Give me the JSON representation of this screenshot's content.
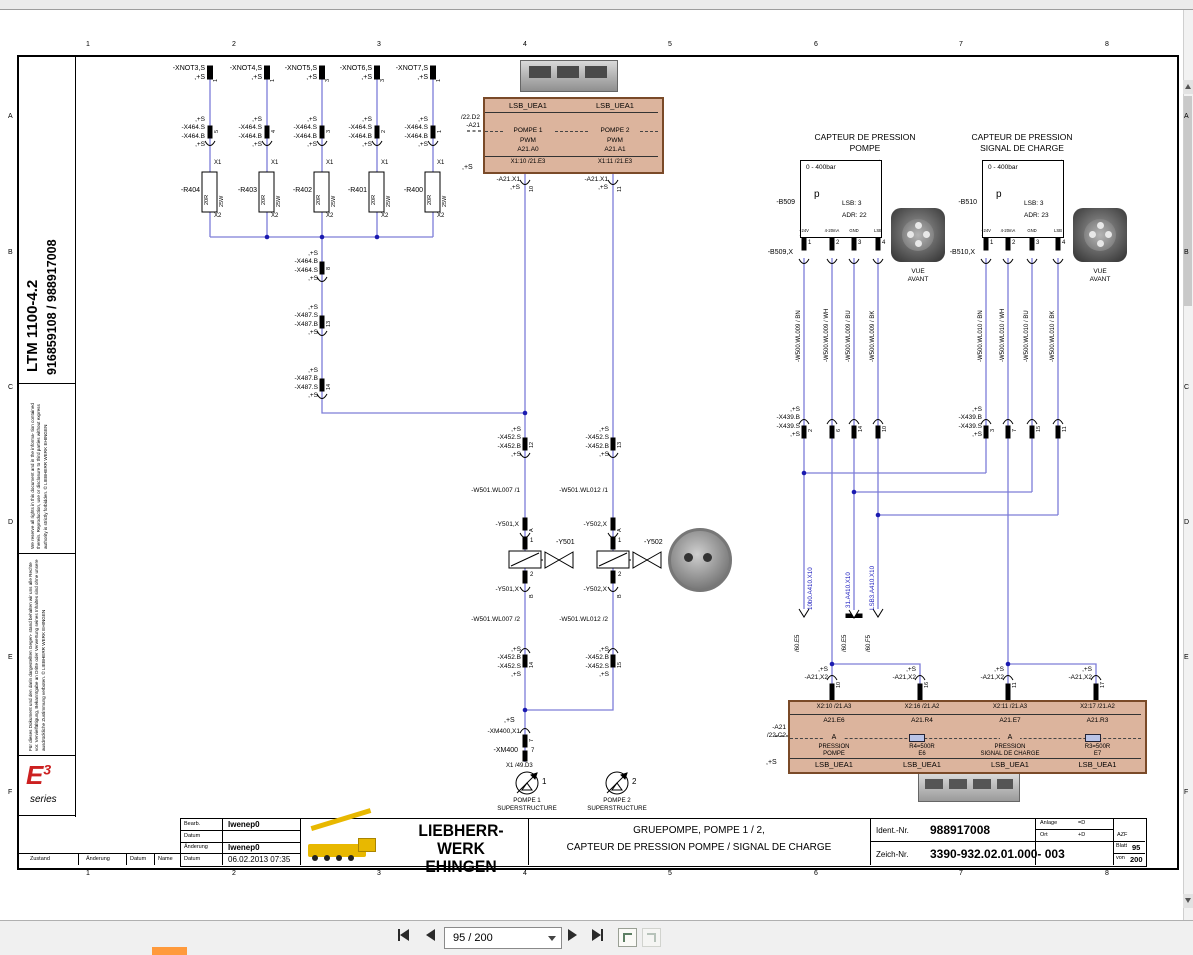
{
  "viewer": {
    "page_indicator": "95 / 200"
  },
  "grid": {
    "cols": [
      "1",
      "2",
      "3",
      "4",
      "5",
      "6",
      "7",
      "8"
    ],
    "rows": [
      "A",
      "B",
      "C",
      "D",
      "E",
      "F"
    ]
  },
  "sidebar": {
    "model": "LTM 1100-4.2",
    "numbers": "916859108  /  988917008",
    "legal_en": "We reserve all rights in this document and in the informa- tion contained therein. Reproduction, use or disclosure to third parties without express authority is strictly forbidden. © LIEBHERR WERK EHINGEN",
    "legal_de": "Für dieses Dokument und den darin dargestellten Gegen- stand behalten wir uns alle Rechte vor. Vervielfältigung, Bekanntgabe an Dritte oder Verwertung seines Inhaltes sind ohne unsere ausdrückliche Zustimmung verboten. © LIEBHERR WERK EHINGEN",
    "e_logo": "E",
    "e_sup": "3",
    "e_series": "series"
  },
  "branches": [
    {
      "top": "-XNOT3,S\n,+S",
      "tpin": "1",
      "conn": ",+S\n-X464.S\n-X464.B\n,+S",
      "pin": "5",
      "x1": "X1",
      "r": "-R404",
      "ohm": "20R",
      "watt": "25W",
      "x2": "X2"
    },
    {
      "top": "-XNOT4,S\n,+S",
      "tpin": "1",
      "conn": ",+S\n-X464.S\n-X464.B\n,+S",
      "pin": "4",
      "x1": "X1",
      "r": "-R403",
      "ohm": "20R",
      "watt": "25W",
      "x2": "X2"
    },
    {
      "top": "-XNOT5,S\n,+S",
      "tpin": "3",
      "conn": ",+S\n-X464.S\n-X464.B\n,+S",
      "pin": "3",
      "x1": "X1",
      "r": "-R402",
      "ohm": "20R",
      "watt": "25W",
      "x2": "X2"
    },
    {
      "top": "-XNOT6,S\n,+S",
      "tpin": "3",
      "conn": ",+S\n-X464.S\n-X464.B\n,+S",
      "pin": "2",
      "x1": "X1",
      "r": "-R401",
      "ohm": "20R",
      "watt": "25W",
      "x2": "X2"
    },
    {
      "top": "-XNOT7,S\n,+S",
      "tpin": "1",
      "conn": ",+S\n-X464.S\n-X464.B\n,+S",
      "pin": "1",
      "x1": "X1",
      "r": "-R400",
      "ohm": "20R",
      "watt": "25W",
      "x2": "X2"
    }
  ],
  "chain": [
    {
      "lbl": ",+S\n-X464.B\n-X464.S\n,+S",
      "pin": "8"
    },
    {
      "lbl": ",+S\n-X487.S\n-X487.B\n,+S",
      "pin": "13"
    },
    {
      "lbl": ",+S\n-X487.B\n-X487.S\n,+S",
      "pin": "14"
    }
  ],
  "top_box": {
    "ref": "/22.D2\n-A21",
    "plus": ",+S",
    "h1": "LSB_UEA1",
    "h2": "LSB_UEA1",
    "c1": {
      "name": "POMPE 1",
      "sig": "PWM",
      "addr": "A21.A0",
      "pin": "X1:10   /21.E3"
    },
    "c2": {
      "name": "POMPE 2",
      "sig": "PWM",
      "addr": "A21.A1",
      "pin": "X1:11   /21.E3"
    },
    "b1": {
      "lbl": "-A21.X1\n,+S",
      "pin": "10"
    },
    "b2": {
      "lbl": "-A21.X1\n,+S",
      "pin": "11"
    }
  },
  "trunk1": {
    "x452t": {
      "lbl": ",+S\n-X452.S\n-X452.B\n,+S",
      "pin": "12"
    },
    "w1": "-W501.WL007 /1",
    "yxa": {
      "lbl": "-Y501,X",
      "pin": "A"
    },
    "cp1": "1",
    "cp2": "2",
    "coil": "-Y501",
    "yxb": {
      "lbl": "-Y501,X",
      "pin": "B"
    },
    "w2": "-W501.WL007 /2",
    "x452b": {
      "lbl": ",+S\n-X452.B\n-X452.S\n,+S",
      "pin": "14"
    },
    "pump": {
      "num": "1",
      "name": "POMPE 1\nSUPERSTRUCTURE"
    }
  },
  "trunk2": {
    "x452t": {
      "lbl": ",+S\n-X452.S\n-X452.B\n,+S",
      "pin": "13"
    },
    "w1": "-W501.WL012 /1",
    "yxa": {
      "lbl": "-Y502,X",
      "pin": "A"
    },
    "cp1": "1",
    "cp2": "2",
    "coil": "-Y502",
    "yxb": {
      "lbl": "-Y502,X",
      "pin": "B"
    },
    "w2": "-W501.WL012 /2",
    "x452b": {
      "lbl": ",+S\n-X452.B\n-X452.S\n,+S",
      "pin": "15"
    },
    "pump": {
      "num": "2",
      "name": "POMPE 2\nSUPERSTRUCTURE"
    }
  },
  "xm400": {
    "plus": ",+S",
    "x1lbl": "-XM400,X1",
    "x1pin": "7",
    "lbl": "-XM400",
    "pin": "7",
    "ref": "X1 /49.D3"
  },
  "sensor1": {
    "title": "CAPTEUR DE PRESSION\nPOMPE",
    "range": "0 - 400bar",
    "p": "p",
    "lsb": "LSB:  3",
    "adr": "ADR:  22",
    "ref": "-B509",
    "conn": "-B509,X",
    "pin_names": [
      "+24V",
      "4-20mA",
      "GND",
      "LSB"
    ],
    "pins": [
      "1",
      "2",
      "3",
      "4"
    ],
    "wires": [
      "-W500.WL009 / BN",
      "-W500.WL009 / WH",
      "-W500.WL009 / BU",
      "-W500.WL009 / BK"
    ],
    "x439": {
      "lbl": ",+S\n-X439.B\n-X439.S\n,+S",
      "pins": [
        "2",
        "6",
        "14",
        "10"
      ]
    },
    "vue": "VUE\nAVANT"
  },
  "sensor2": {
    "title": "CAPTEUR DE PRESSION\nSIGNAL DE CHARGE",
    "range": "0 - 400bar",
    "p": "p",
    "lsb": "LSB:  3",
    "adr": "ADR:  23",
    "ref": "-B510",
    "conn": "-B510,X",
    "pin_names": [
      "+24V",
      "4-20mA",
      "GND",
      "LSB"
    ],
    "pins": [
      "1",
      "2",
      "3",
      "4"
    ],
    "wires": [
      "-W500.WL010 / BN",
      "-W500.WL010 / WH",
      "-W500.WL010 / BU",
      "-W500.WL010 / BK"
    ],
    "x439": {
      "lbl": ",+S\n-X439.B\n-X439.S\n,+S",
      "pins": [
        "3",
        "7",
        "15",
        "11"
      ]
    },
    "vue": "VUE\nAVANT"
  },
  "offpage": [
    {
      "flag": "/60.E5",
      "lbl": "10b0.A410.X10"
    },
    {
      "flag": "/60.E5",
      "lbl": "31.A410.X10"
    },
    {
      "flag": "/60.F5",
      "lbl": "LSB3.A410.X10"
    }
  ],
  "bottom_box": {
    "ref": "-A21\n/22.C2",
    "plus": ",+S",
    "tops": [
      {
        "lbl": ",+S\n-A21,X2",
        "pin": "10"
      },
      {
        "lbl": ",+S\n-A21,X2",
        "pin": "16"
      },
      {
        "lbl": ",+S\n-A21,X2",
        "pin": "11"
      },
      {
        "lbl": ",+S\n-A21,X2",
        "pin": "17"
      }
    ],
    "cols": [
      {
        "pin": "X2:10  /21.A3",
        "addr": "A21.E6",
        "sym": "A",
        "l1": "PRESSION",
        "l2": "POMPE",
        "ftr": "LSB_UEA1"
      },
      {
        "pin": "X2:16  /21.A2",
        "addr": "A21.R4",
        "sym": "",
        "l1": "R4=500R",
        "l2": "E6",
        "ftr": "LSB_UEA1"
      },
      {
        "pin": "X2:11  /21.A3",
        "addr": "A21.E7",
        "sym": "A",
        "l1": "PRESSION",
        "l2": "SIGNAL DE CHARGE",
        "ftr": "LSB_UEA1"
      },
      {
        "pin": "X2:17  /21.A2",
        "addr": "A21.R3",
        "sym": "",
        "l1": "R3=500R",
        "l2": "E7",
        "ftr": "LSB_UEA1"
      }
    ]
  },
  "title_block": {
    "bearb_l": "Bearb.",
    "bearb_v": "lwenep0",
    "datum_l": "Datum",
    "datum_v": "",
    "aend_l": "Änderung",
    "aend_v": "lwenep0",
    "datum2_l": "Datum",
    "datum2_v": "06.02.2013  07:35",
    "company1": "LIEBHERR-WERK",
    "company2": "EHINGEN",
    "title1": "GRUEPOMPE, POMPE 1 / 2,",
    "title2": "CAPTEUR DE PRESSION POMPE / SIGNAL DE CHARGE",
    "ident_l": "Ident.-Nr.",
    "ident_v": "988917008",
    "anlage_l": "Anlage",
    "anlage_v": "=D",
    "ort_l": "Ort",
    "ort_v": "+D",
    "azf": "AZF",
    "zeich_l": "Zeich-Nr.",
    "zeich_v": "3390-932.02.01.000-  003",
    "blatt_l": "Blatt",
    "blatt_v": "95",
    "von_l": "von",
    "von_v": "200",
    "zustand": "Zustand",
    "aenderung": "Änderung",
    "datum": "Datum",
    "name": "Name"
  }
}
